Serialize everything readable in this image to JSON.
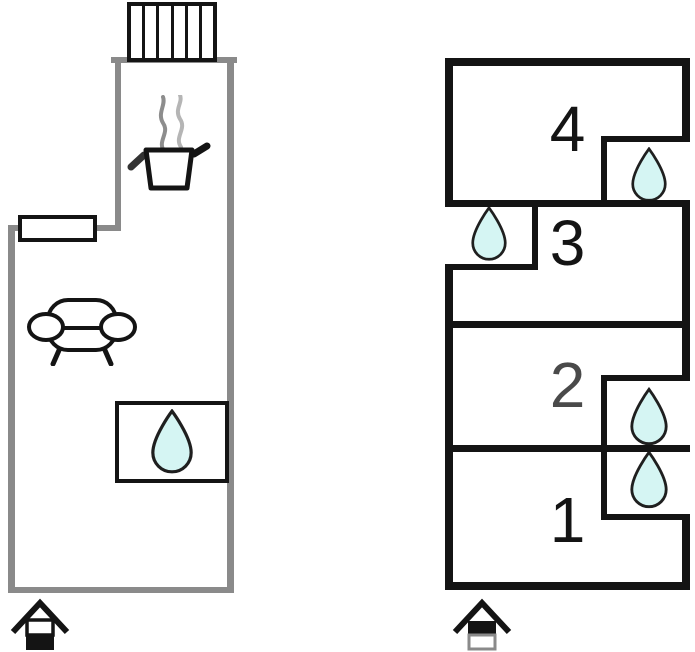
{
  "title": "holiday-house-floor-plan",
  "colors": {
    "wall_gray": "#8a8a8a",
    "wall_black": "#141414",
    "drop_fill": "#d5f5f3",
    "drop_stroke": "#1f1f1f",
    "room2_label": "#4a4a4a"
  },
  "left_plan": {
    "floor": "ground-floor",
    "icons": [
      "stairs-icon",
      "steam-icon",
      "cooking-pot-icon",
      "sofa-icon",
      "window-symbol",
      "water-drop-icon",
      "ground-floor-house-icon"
    ],
    "water_drops": 1
  },
  "right_plan": {
    "floor": "upper-floor",
    "rooms": [
      {
        "label": "4",
        "has_water_drop": true
      },
      {
        "label": "3",
        "has_water_drop": true
      },
      {
        "label": "2",
        "has_water_drop": true
      },
      {
        "label": "1",
        "has_water_drop": true
      }
    ],
    "icons": [
      "water-drop-icon",
      "upper-floor-house-icon"
    ],
    "water_drops": 4
  }
}
